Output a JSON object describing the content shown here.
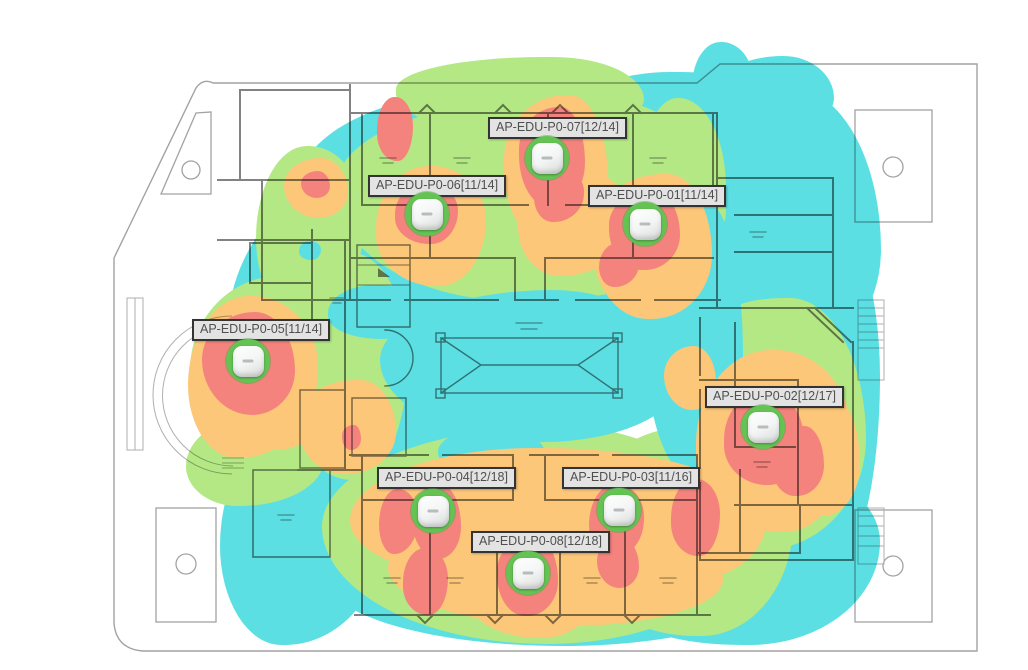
{
  "view": {
    "type": "wifi-coverage-heatmap-floorplan",
    "floor": "P0"
  },
  "heatmap": {
    "colors": {
      "strong": "#f5837d",
      "good": "#fcc778",
      "fair": "#b4e884",
      "weak": "#5cdfe3"
    },
    "ap_ring_color": "#64c353",
    "ap_body_color": "#ffffff",
    "label_bg": "#e3e3e3",
    "label_border": "#333333"
  },
  "aps": [
    {
      "id": "ap-edu-p0-07",
      "label": "AP-EDU-P0-07[12/14]",
      "x": 547,
      "y": 158,
      "label_x": 488,
      "label_y": 117
    },
    {
      "id": "ap-edu-p0-06",
      "label": "AP-EDU-P0-06[11/14]",
      "x": 427,
      "y": 214,
      "label_x": 368,
      "label_y": 175
    },
    {
      "id": "ap-edu-p0-01",
      "label": "AP-EDU-P0-01[11/14]",
      "x": 645,
      "y": 224,
      "label_x": 588,
      "label_y": 185
    },
    {
      "id": "ap-edu-p0-05",
      "label": "AP-EDU-P0-05[11/14]",
      "x": 248,
      "y": 361,
      "label_x": 192,
      "label_y": 319
    },
    {
      "id": "ap-edu-p0-02",
      "label": "AP-EDU-P0-02[12/17]",
      "x": 763,
      "y": 427,
      "label_x": 705,
      "label_y": 386
    },
    {
      "id": "ap-edu-p0-04",
      "label": "AP-EDU-P0-04[12/18]",
      "x": 433,
      "y": 511,
      "label_x": 377,
      "label_y": 467
    },
    {
      "id": "ap-edu-p0-03",
      "label": "AP-EDU-P0-03[11/16]",
      "x": 619,
      "y": 510,
      "label_x": 562,
      "label_y": 467
    },
    {
      "id": "ap-edu-p0-08",
      "label": "AP-EDU-P0-08[12/18]",
      "x": 528,
      "y": 573,
      "label_x": 471,
      "label_y": 531
    }
  ]
}
